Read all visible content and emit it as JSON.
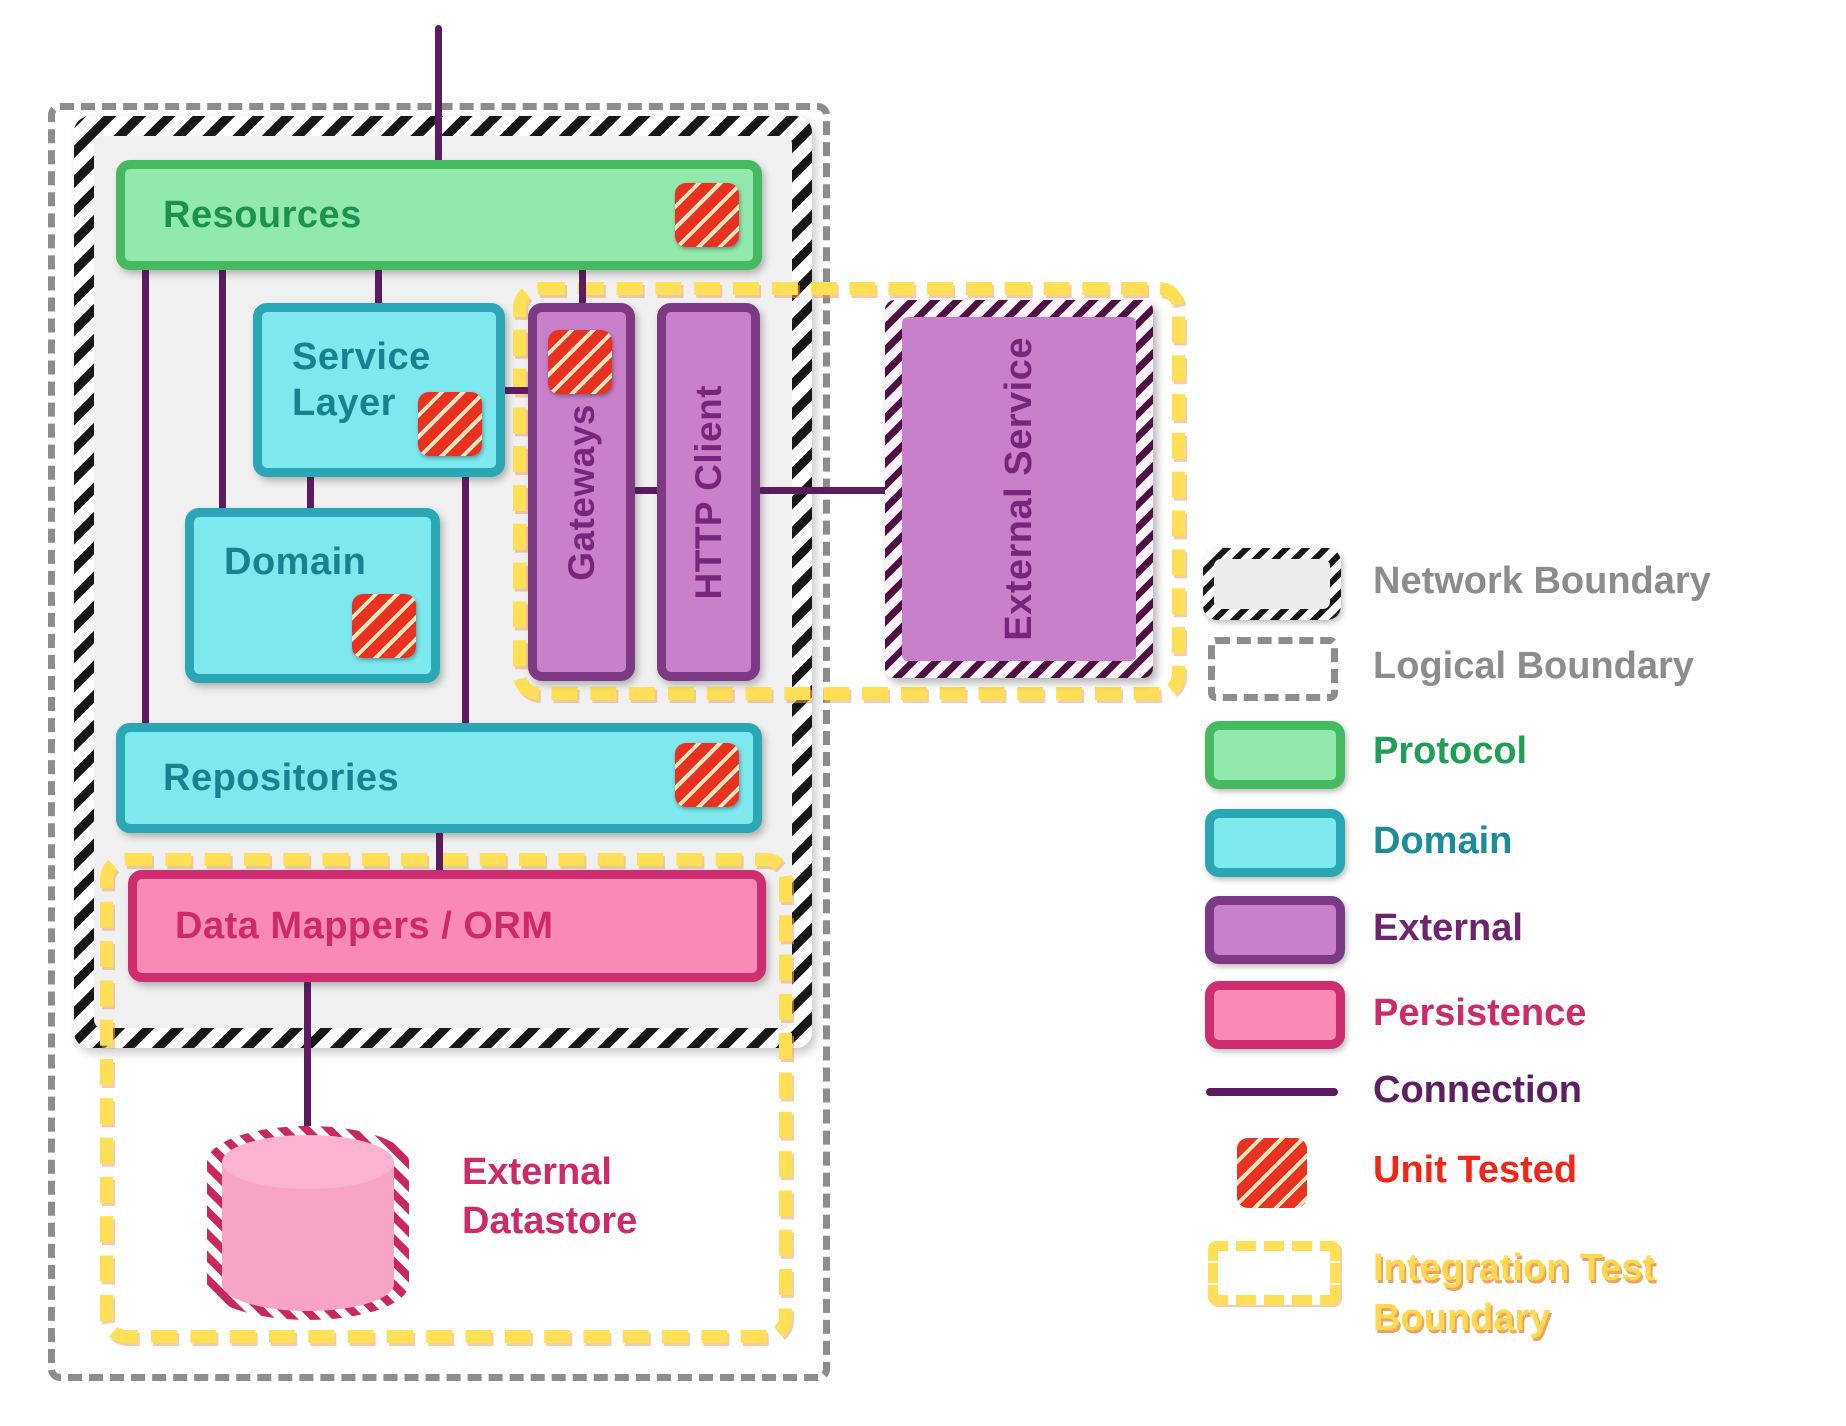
{
  "nodes": {
    "resources": "Resources",
    "service_layer": "Service Layer",
    "domain": "Domain",
    "gateways": "Gateways",
    "http_client": "HTTP Client",
    "external_service": "External Service",
    "repositories": "Repositories",
    "data_mappers": "Data Mappers / ORM",
    "external_datastore": "External Datastore"
  },
  "legend": {
    "items": [
      {
        "id": "network-boundary",
        "label": "Network Boundary"
      },
      {
        "id": "logical-boundary",
        "label": "Logical Boundary"
      },
      {
        "id": "protocol",
        "label": "Protocol"
      },
      {
        "id": "domain",
        "label": "Domain"
      },
      {
        "id": "external",
        "label": "External"
      },
      {
        "id": "persistence",
        "label": "Persistence"
      },
      {
        "id": "connection",
        "label": "Connection"
      },
      {
        "id": "unit-tested",
        "label": "Unit Tested"
      },
      {
        "id": "integration-test-boundary",
        "label": "Integration Test Boundary"
      }
    ]
  },
  "colors": {
    "protocol_fill": "#92e9ae",
    "protocol_border": "#45ba60",
    "protocol_text": "#1e9150",
    "domain_fill": "#7de9ee",
    "domain_border": "#2ba6b4",
    "domain_text": "#15828e",
    "external_fill": "#c980cb",
    "external_border": "#7c3a85",
    "external_text": "#76277c",
    "persistence_fill": "#f98ab7",
    "persistence_border": "#ce2e6f",
    "persistence_text": "#ce296b",
    "connection_line": "#5c1b60",
    "unit_tested_red": "#e93120",
    "integration_yellow": "#ffdf55",
    "boundary_gray": "#8d8d8d",
    "network_interior": "#f0f0f0"
  }
}
